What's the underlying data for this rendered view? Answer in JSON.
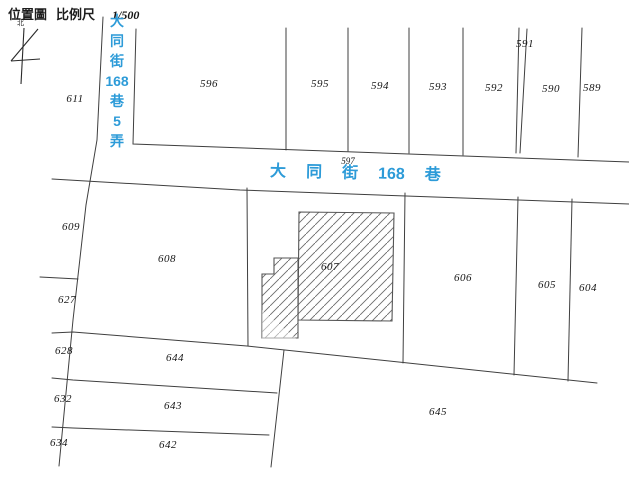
{
  "header": {
    "map_label": "位置圖",
    "scale_label": "比例尺",
    "scale_value": "1/500",
    "north_label": "北"
  },
  "roads": {
    "lane_name": "大同街168巷5弄",
    "lane_segments": [
      "大",
      "同",
      "街",
      "168",
      "巷",
      "5",
      "弄"
    ],
    "main_name": "大同街168巷",
    "main_segments": [
      "大",
      "同",
      "街",
      "168",
      "巷"
    ]
  },
  "parcels": [
    {
      "id": "611"
    },
    {
      "id": "596"
    },
    {
      "id": "595"
    },
    {
      "id": "594"
    },
    {
      "id": "593"
    },
    {
      "id": "592"
    },
    {
      "id": "591"
    },
    {
      "id": "590"
    },
    {
      "id": "589"
    },
    {
      "id": "597"
    },
    {
      "id": "609"
    },
    {
      "id": "608"
    },
    {
      "id": "607"
    },
    {
      "id": "606"
    },
    {
      "id": "605"
    },
    {
      "id": "604"
    },
    {
      "id": "627"
    },
    {
      "id": "628"
    },
    {
      "id": "644"
    },
    {
      "id": "632"
    },
    {
      "id": "643"
    },
    {
      "id": "634"
    },
    {
      "id": "642"
    },
    {
      "id": "645"
    }
  ],
  "building": {
    "parcel": "607",
    "style": "diagonal-hatched"
  },
  "colors": {
    "road_text_blue": "#2d9bd8",
    "boundary_line": "#3f3f3f",
    "hatch_line": "#6b6b6b",
    "background": "#ffffff"
  }
}
